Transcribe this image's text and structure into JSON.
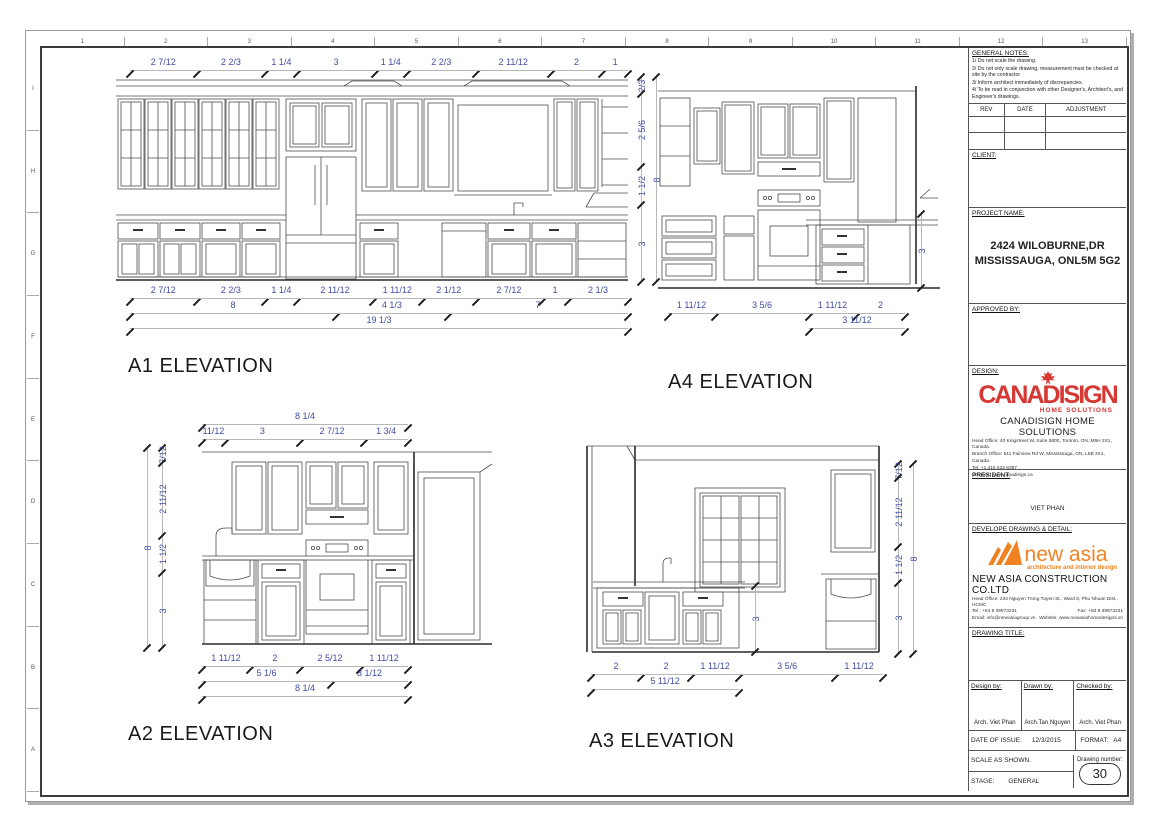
{
  "sheet": {
    "top_ruler": [
      "1",
      "2",
      "3",
      "4",
      "5",
      "6",
      "7",
      "8",
      "9",
      "10",
      "11",
      "12",
      "13"
    ],
    "left_ruler": [
      "I",
      "H",
      "G",
      "F",
      "E",
      "D",
      "C",
      "B",
      "A"
    ]
  },
  "elevations": {
    "a1": {
      "label": "A1 ELEVATION",
      "top": [
        "2 7/12",
        "2 2/3",
        "1 1/4",
        "3",
        "1 1/4",
        "2 2/3",
        "2 11/12",
        "2",
        "1"
      ],
      "right": [
        "2/3",
        "2 5/6",
        "1 1/2",
        "3"
      ],
      "right_total": "8",
      "bottom1": [
        "2 7/12",
        "2 2/3",
        "1 1/4",
        "2 11/12",
        "1 11/12",
        "2 1/12",
        "2 7/12",
        "1",
        "2 1/3"
      ],
      "bottom2": [
        "8",
        "4 1/3",
        "7"
      ],
      "bottom_total": "19 1/3"
    },
    "a2": {
      "label": "A2 ELEVATION",
      "top_total": "8 1/4",
      "top": [
        "11/12",
        "3",
        "2 7/12",
        "1 3/4"
      ],
      "left": [
        "7/12",
        "2 11/12",
        "1 1/2",
        "3"
      ],
      "left_total": "8",
      "bottom1": [
        "1 11/12",
        "2",
        "2 5/12",
        "1 11/12"
      ],
      "bottom2": [
        "5 1/6",
        "3 1/12"
      ],
      "bottom_total": "8 1/4"
    },
    "a3": {
      "label": "A3 ELEVATION",
      "bottom1": [
        "2",
        "2",
        "1 11/12",
        "3 5/6",
        "1 11/12"
      ],
      "bottom2_label": "5 11/12",
      "right": [
        "7/12",
        "2 11/12",
        "1 1/2",
        "3"
      ],
      "right_total": "8",
      "island_height": "3"
    },
    "a4": {
      "label": "A4 ELEVATION",
      "bottom1": [
        "1 11/12",
        "3 5/6",
        "1 11/12",
        "2"
      ],
      "bottom2_label": "3 11/12",
      "counter_height": "3"
    }
  },
  "title_block": {
    "general_notes_heading": "GENERAL NOTES:",
    "general_notes": [
      "1/ Do not scale the drawing.",
      "2/ Do not only scale drawing, measurement must be checked at site by the contractor",
      "3/ Inform architect immediately of discrepancies.",
      "4/ To be read in conjunction with other Designer's, Architect's, and Engineer's drawings."
    ],
    "rev_headers": [
      "REV",
      "DATE",
      "ADJUSTMENT"
    ],
    "client_label": "CLIENT:",
    "project_label": "PROJECT NAME:",
    "project_name_line1": "2424 WILOBURNE,DR",
    "project_name_line2": "MISSISSAUGA, ONL5M 5G2",
    "approved_label": "APPROVED BY:",
    "design": {
      "label": "DESIGN:",
      "logo_text": "CANADISIGN",
      "logo_sub": "HOME SOLUTIONS",
      "company": "CANADISIGN HOME SOLUTIONS",
      "address1": "Head Office: 40 Kingstreet W, Suite 5800, Toronto, ON, M5H 3S1, Canada.",
      "address2": "Branch Office: 511 Fairview Rd W, Mississauga, ON, L5B 3X1, Canada.",
      "tel": "Tel: +1 416 523 8387",
      "website": "Website: www.canadisign.ca"
    },
    "president_label": "PRESIDENT:",
    "president_name": "VIET PHAN",
    "developer": {
      "label": "DEVELOPE DRAWING & DETAIL:",
      "logo_text": "new asia",
      "logo_sub": "architecture and interior design",
      "company": "NEW ASIA CONSTRUCTION CO.LTD",
      "address": "Head Office: 234 Nguyen Trong Tuyen St., Ward 8, Phu Nhuan Dist., HCMC",
      "tel": "Tel : +84 8 39973231",
      "fax": "Fax: +84 8 39973231",
      "email": "Email: info@newasiagroup.vn",
      "website": "Website: www.newasiahomedesigns.vn"
    },
    "drawing_title_label": "DRAWING TITLE:",
    "credits": {
      "design_by_label": "Design by:",
      "design_by": "Arch. Viet Phan",
      "drawn_by_label": "Drawn by:",
      "drawn_by": "Arch.Tan Nguyen",
      "checked_by_label": "Checked by:",
      "checked_by": "Arch. Viet Phan"
    },
    "issue": {
      "date_label": "DATE OF ISSUE:",
      "date": "12/3/2015",
      "format_label": "FORMAT:",
      "format": "A4"
    },
    "scale_label": "SCALE AS SHOWN.",
    "stage_label": "STAGE:",
    "stage": "GENERAL",
    "drawing_number_label": "Drawing number:",
    "drawing_number": "30"
  },
  "colors": {
    "dim_text": "#3f4da4",
    "logo_red": "#d63833",
    "logo_orange": "#f08221",
    "line": "#4d4d4d"
  }
}
